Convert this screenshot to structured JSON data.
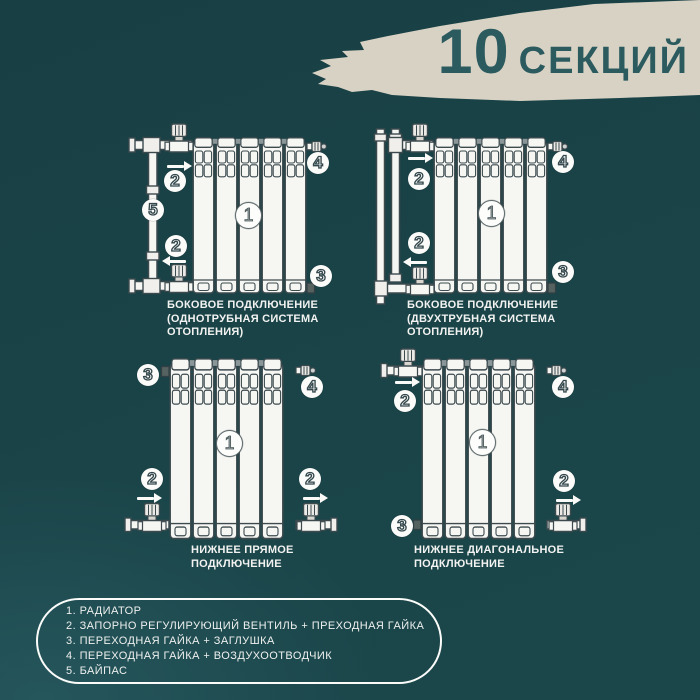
{
  "header": {
    "count": "10",
    "unit": "СЕКЦИЙ"
  },
  "diagrams": [
    {
      "name": "side-connection-one-pipe",
      "caption": "БОКОВОЕ ПОДКЛЮЧЕНИЕ\n(ОДНОТРУБНАЯ СИСТЕМА\nОТОПЛЕНИЯ)",
      "callouts": [
        "2",
        "5",
        "2",
        "1",
        "4",
        "3"
      ]
    },
    {
      "name": "side-connection-two-pipe",
      "caption": "БОКОВОЕ ПОДКЛЮЧЕНИЕ\n(ДВУХТРУБНАЯ СИСТЕМА\nОТОПЛЕНИЯ)",
      "callouts": [
        "2",
        "2",
        "1",
        "4",
        "3"
      ]
    },
    {
      "name": "bottom-straight-connection",
      "caption": "НИЖНЕЕ ПРЯМОЕ\nПОДКЛЮЧЕНИЕ",
      "callouts": [
        "3",
        "4",
        "1",
        "2",
        "2"
      ]
    },
    {
      "name": "bottom-diagonal-connection",
      "caption": "НИЖНЕЕ ДИАГОНАЛЬНОЕ\nПОДКЛЮЧЕНИЕ",
      "callouts": [
        "2",
        "4",
        "1",
        "2",
        "3"
      ]
    }
  ],
  "legend": {
    "items": [
      "1. РАДИАТОР",
      "2. ЗАПОРНО РЕГУЛИРУЮЩИЙ ВЕНТИЛЬ + ПРЕХОДНАЯ ГАЙКА",
      "3. ПЕРЕХОДНАЯ ГАЙКА + ЗАГЛУШКА",
      "4. ПЕРЕХОДНАЯ ГАЙКА + ВОЗДУХООТВОДЧИК",
      "5. БАЙПАС"
    ]
  },
  "colors": {
    "background": "#1a4448",
    "brush": "#d8d2c4",
    "title": "#2b5a5f",
    "diagram_line": "#3c4a4e",
    "diagram_fill": "#f6f6f3",
    "text": "#f2f3f1"
  }
}
